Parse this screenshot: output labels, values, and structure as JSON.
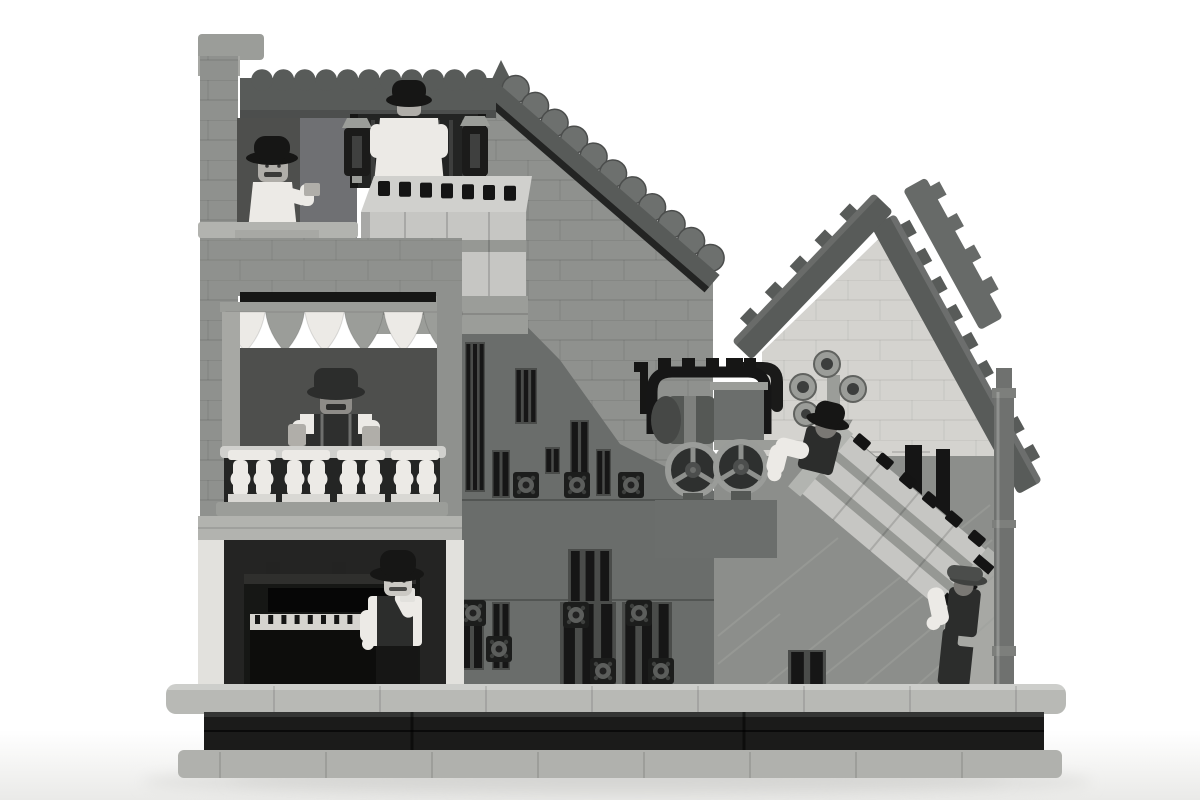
{
  "scene": {
    "type": "rendered-lego-model-photo",
    "style": "black-and-white grayscale render on white background",
    "elements": [
      "three-story-townhouse-left",
      "scalloped-parapet",
      "tea-drinker-minifig",
      "organ-and-player-minifig",
      "hanging-lanterns",
      "crate-on-landing",
      "awning-pennants",
      "balcony-minifig-with-steins",
      "white-balustrade",
      "upright-piano",
      "pianist-minifig",
      "long-sloped-roof",
      "ornate-slat-wall",
      "rosette-ornaments",
      "black-arch-rail",
      "small-locomotive",
      "spoked-wheels",
      "pipe-flanges",
      "tilted-gabled-house",
      "studded-roof-boards",
      "drainpipe",
      "tilted-piano-crate",
      "upper-mover-minifig",
      "lower-mover-minifig",
      "stone-base-plinth",
      "black-base-band",
      "ground-shadow"
    ]
  },
  "figures": [
    {
      "name": "man-with-teacup",
      "hat": "bowler",
      "location": "top-floor"
    },
    {
      "name": "man-at-organ",
      "hat": "bowler",
      "location": "top-landing",
      "view": "from-behind"
    },
    {
      "name": "man-with-two-steins",
      "hat": "bowler",
      "location": "middle-balcony"
    },
    {
      "name": "man-at-piano",
      "hat": "bowler",
      "location": "ground-floor"
    },
    {
      "name": "upper-crate-mover",
      "hat": "bowler",
      "location": "on-slope-upper-end"
    },
    {
      "name": "lower-crate-mover",
      "hat": "flat-cap",
      "location": "on-slope-lower-end"
    }
  ],
  "colors": {
    "bg": "#ffffff",
    "floor_shade": "#ebebe9",
    "shadow": "#dededd",
    "shadow2": "#d2d2d0",
    "base_light": "#b8b9b5",
    "base_light2": "#b0b1ad",
    "black_band": "#1b1b1a",
    "wall_mid": "#8f918e",
    "wall_dark": "#6a6d6b",
    "steel_wall": "#8c8e8b",
    "roof_dark": "#585b59",
    "roof_upper": "#676a68",
    "roof_tile": "#6d706e",
    "house_wall": "#d4d3cf",
    "interior_dark": "#4e4f4d",
    "interior_black": "#242423",
    "white_piece": "#eceae6",
    "white_trim": "#e2e1dd",
    "slab": "#b2b3af",
    "steel": "#9b9d99",
    "steel2": "#a7a8a4",
    "black_piece": "#161615",
    "black_soft": "#2c2d2c",
    "fig_skin": "#b0aea9",
    "fig_skin_dark": "#7a7874",
    "fig_skin_light": "#cbc9c4",
    "crate": "#c6c6c3",
    "crate_top": "#d0d0cd",
    "crate_strap": "#969894",
    "piano": "#161715",
    "piano_keys": "#d6d4cf",
    "pipe": "#6f716f",
    "boiler": "#555855",
    "vest": "#2e2f2e",
    "cap_gray": "#4b4d4b"
  },
  "decor": {
    "parapet_scallops": 11,
    "roof_shingles": 11,
    "awning_pennants": 6,
    "baluster_groups": 4,
    "piano_keys": 12,
    "landing_crate_slots": 7,
    "tilted_crate_slots": 6,
    "roof_studs_left": 5,
    "roof_studs_right": 9,
    "roof_studs_upper": 4,
    "slat_panels": [
      [
        465,
        342,
        20,
        150,
        3
      ],
      [
        515,
        368,
        22,
        56,
        3
      ],
      [
        492,
        450,
        18,
        48,
        2
      ],
      [
        545,
        447,
        15,
        27,
        2
      ],
      [
        570,
        420,
        19,
        54,
        2
      ],
      [
        596,
        449,
        15,
        47,
        2
      ],
      [
        623,
        473,
        17,
        25,
        2
      ],
      [
        568,
        549,
        44,
        54,
        3
      ],
      [
        460,
        602,
        24,
        68,
        2
      ],
      [
        492,
        602,
        18,
        68,
        2
      ],
      [
        560,
        602,
        56,
        86,
        3
      ],
      [
        622,
        602,
        50,
        86,
        3
      ],
      [
        788,
        650,
        38,
        38,
        2
      ],
      [
        905,
        445,
        17,
        108,
        1
      ],
      [
        936,
        449,
        14,
        100,
        1
      ]
    ],
    "rosettes": [
      [
        513,
        472
      ],
      [
        564,
        472
      ],
      [
        618,
        472
      ],
      [
        460,
        600
      ],
      [
        486,
        636
      ],
      [
        563,
        602
      ],
      [
        590,
        658
      ],
      [
        626,
        600
      ],
      [
        648,
        658
      ]
    ],
    "step_lines": [
      [
        760,
        690,
        990,
        505
      ],
      [
        806,
        690,
        992,
        540
      ],
      [
        858,
        690,
        994,
        576
      ],
      [
        912,
        690,
        996,
        616
      ],
      [
        718,
        636,
        838,
        538
      ],
      [
        718,
        664,
        780,
        614
      ]
    ]
  }
}
